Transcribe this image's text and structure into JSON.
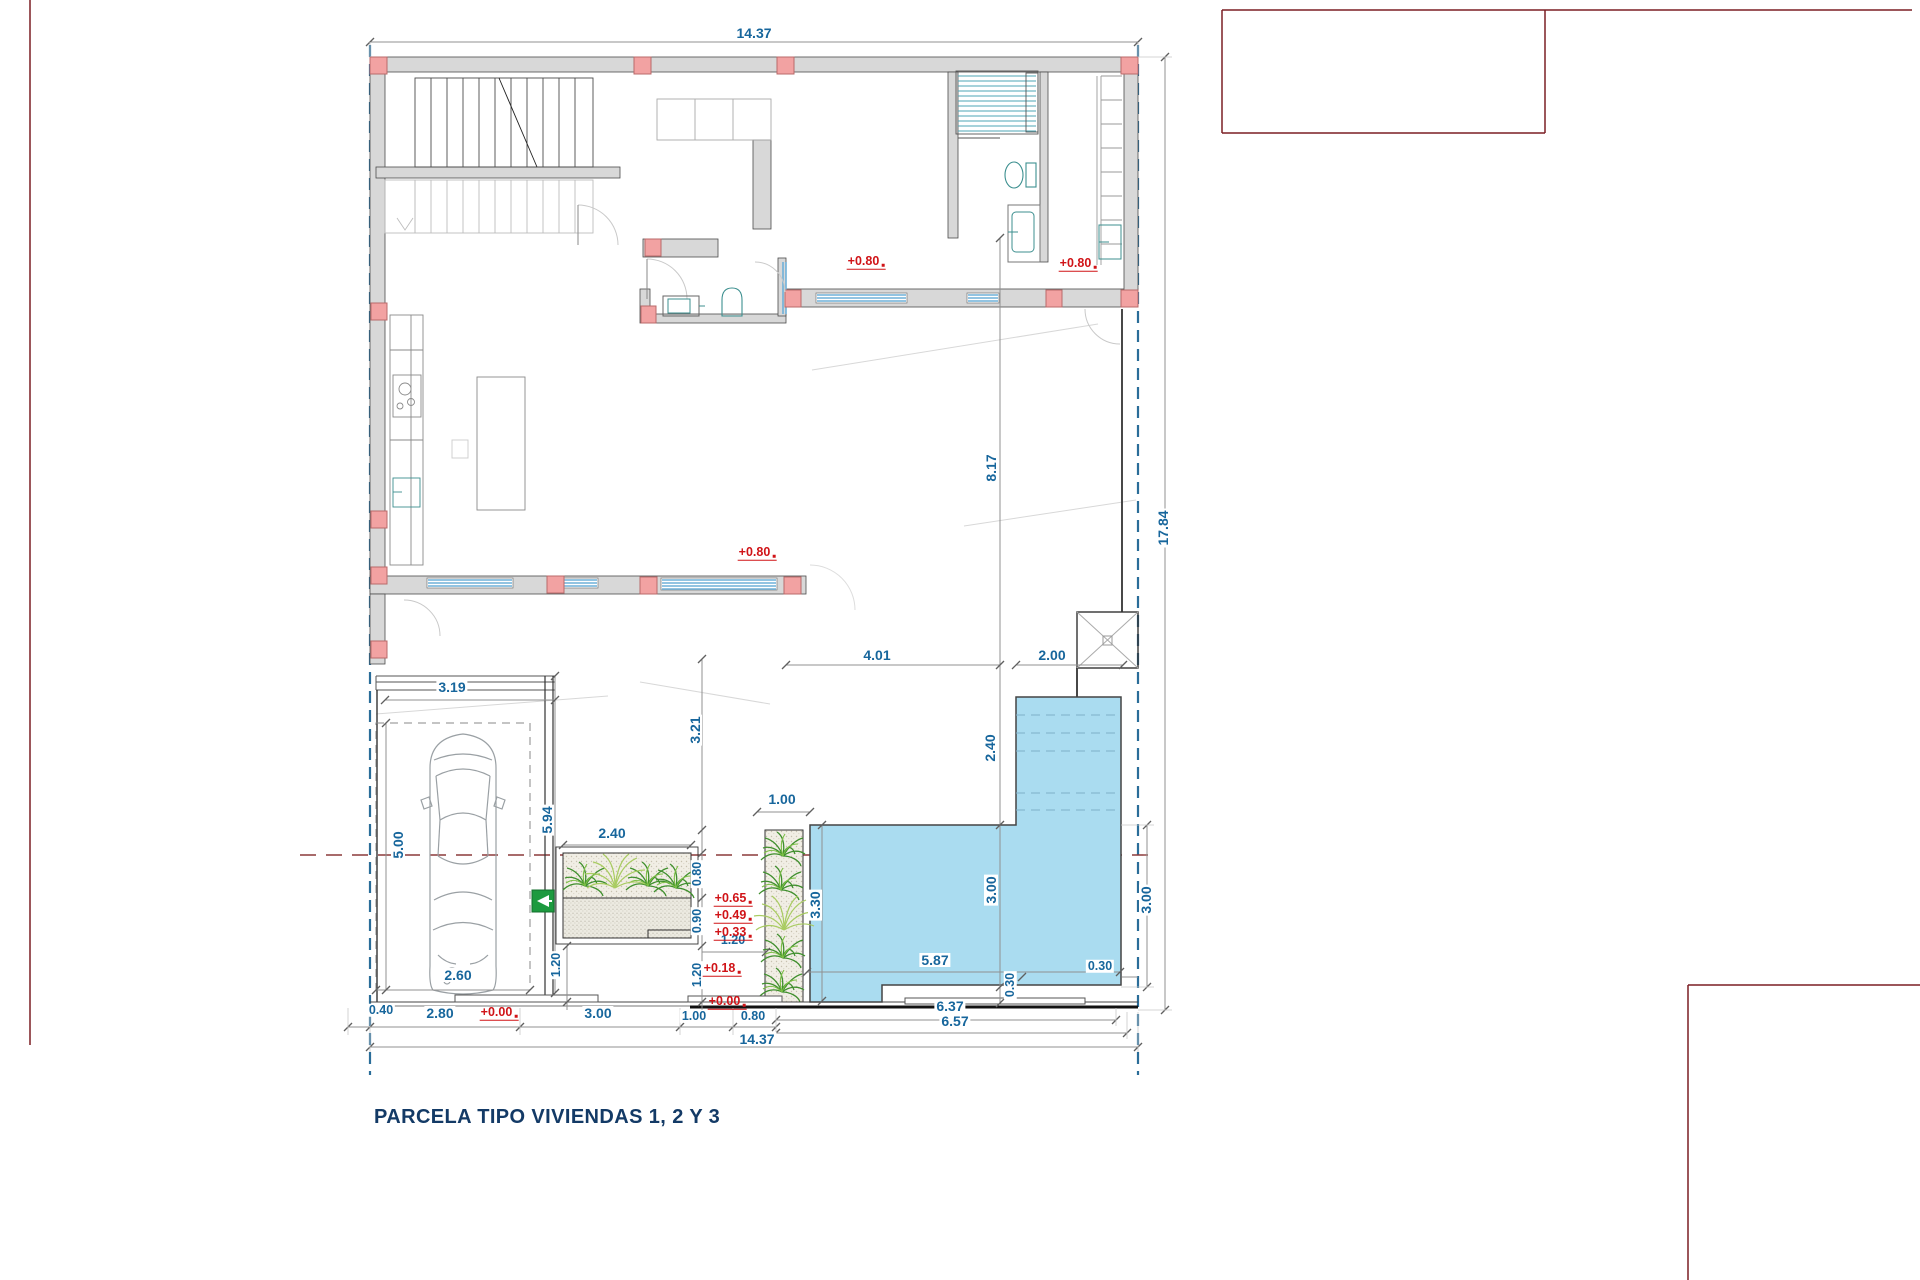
{
  "title": "PARCELA TIPO VIVIENDAS 1, 2 Y 3",
  "dims": {
    "top_width": "14.37",
    "right_height": "17.84",
    "terrace_len": "8.17",
    "patio_a": "4.01",
    "patio_b": "2.00",
    "pool_arm": "2.40",
    "pool_h": "3.00",
    "pool_side": "3.30",
    "pool_right": "3.00",
    "pool_w": "5.87",
    "pool_off_bottom": "0.30",
    "pool_off_right": "0.30",
    "court_h": "3.21",
    "planter_w": "2.40",
    "palm_w": "1.00",
    "planter_h1": "0.80",
    "planter_h2": "0.90",
    "walk_a": "1.20",
    "walk_b": "1.20",
    "walk_c": "1.20",
    "garage_w": "3.19",
    "garage_len": "5.94",
    "park_len": "5.00",
    "park_w": "2.60",
    "setback": "0.40",
    "b1": "2.80",
    "b2": "3.00",
    "b3": "1.00",
    "b4": "0.80",
    "b5": "6.37",
    "b6": "6.57",
    "bottom_width": "14.37"
  },
  "levels": {
    "l080a": "+0.80",
    "l080b": "+0.80",
    "l080c": "+0.80",
    "l065": "+0.65",
    "l049": "+0.49",
    "l033": "+0.33",
    "l018": "+0.18",
    "l000a": "+0.00",
    "l000b": "+0.00"
  },
  "icons": {
    "car": "car-top-view-icon",
    "charger": "ev-charger-icon",
    "palm": "palm-plant-icon",
    "shower": "shower-icon",
    "toilet": "toilet-icon",
    "sink": "sink-icon",
    "stairs": "staircase",
    "skylight": "skylight-x-marker"
  },
  "colors": {
    "dim_text": "#17669C",
    "elevation_text": "#D01317",
    "boundary": "#2A6D99",
    "pool_fill": "#AADCF0",
    "wall_fill": "#D8D8D8",
    "column_fill": "#F2A2A2",
    "plant_green": "#3F8F2D",
    "charger_green": "#1D9A3F",
    "sheet_line": "#7B1F24",
    "title_color": "#133A66"
  }
}
